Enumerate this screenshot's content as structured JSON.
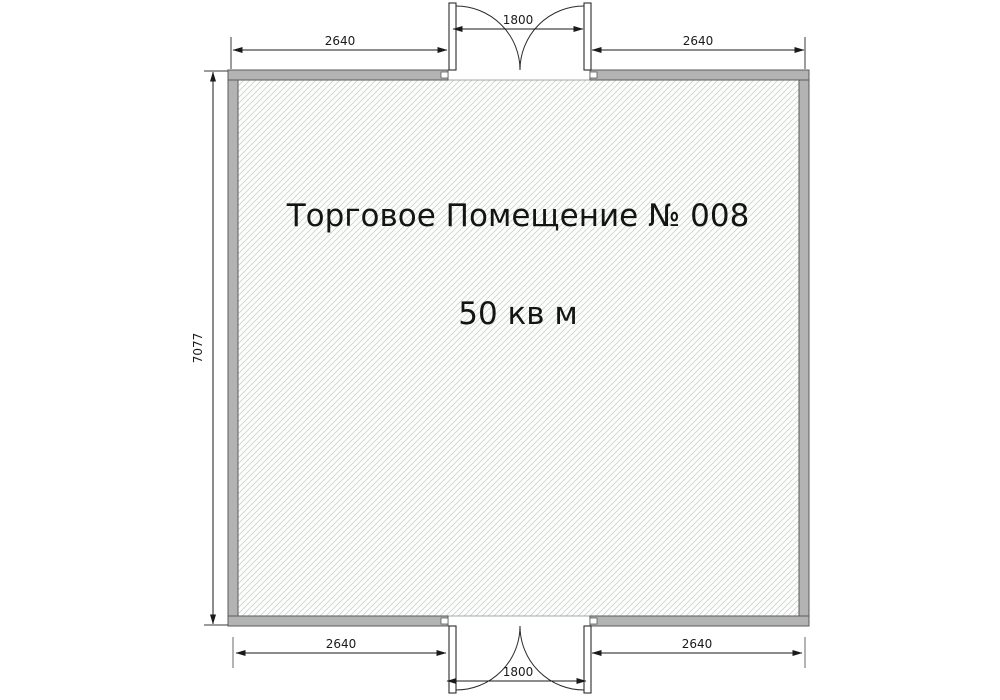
{
  "plan": {
    "title": "Торговое Помещение № 008",
    "area_label": "50 кв м",
    "dims": {
      "top_left_width": "2640",
      "top_door_width": "1800",
      "top_right_width": "2640",
      "side_height": "7077",
      "bottom_left_width": "2640",
      "bottom_door_width": "1800",
      "bottom_right_width": "2640"
    },
    "colors": {
      "wall_fill": "#b3b3b3",
      "wall_stroke": "#5b5b5b",
      "hatch_line": "#c9d6c9",
      "hatch_background": "#fdfefd",
      "dimension_line": "#1a1a1a",
      "text": "#141414",
      "page_background": "#ffffff"
    }
  }
}
